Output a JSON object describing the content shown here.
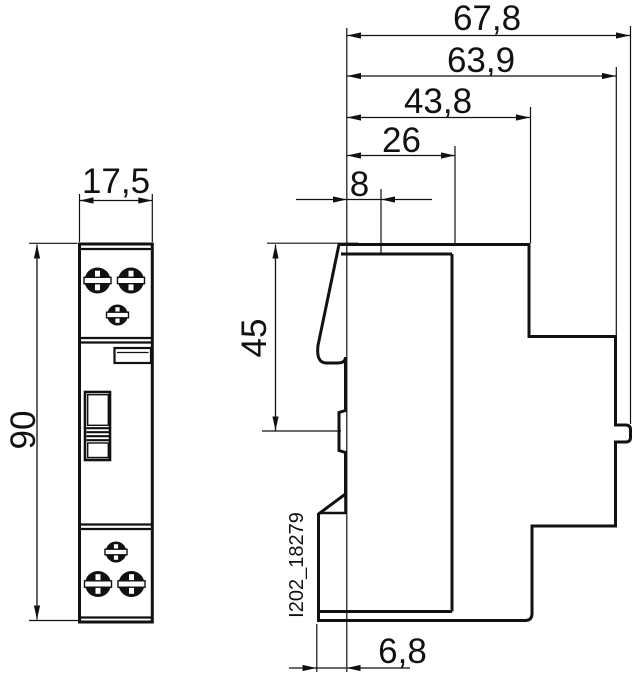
{
  "drawing_code": "I202_18279",
  "colors": {
    "line": "#111111",
    "background": "#ffffff"
  },
  "dims": {
    "total_depth": {
      "label": "67,8"
    },
    "body_depth": {
      "label": "63,9"
    },
    "step_depth": {
      "label": "43,8"
    },
    "front_depth": {
      "label": "26"
    },
    "front_offset": {
      "label": "8"
    },
    "front_height": {
      "label": "45"
    },
    "height": {
      "label": "90"
    },
    "width": {
      "label": "17,5"
    },
    "bottom_offset": {
      "label": "6,8"
    }
  }
}
